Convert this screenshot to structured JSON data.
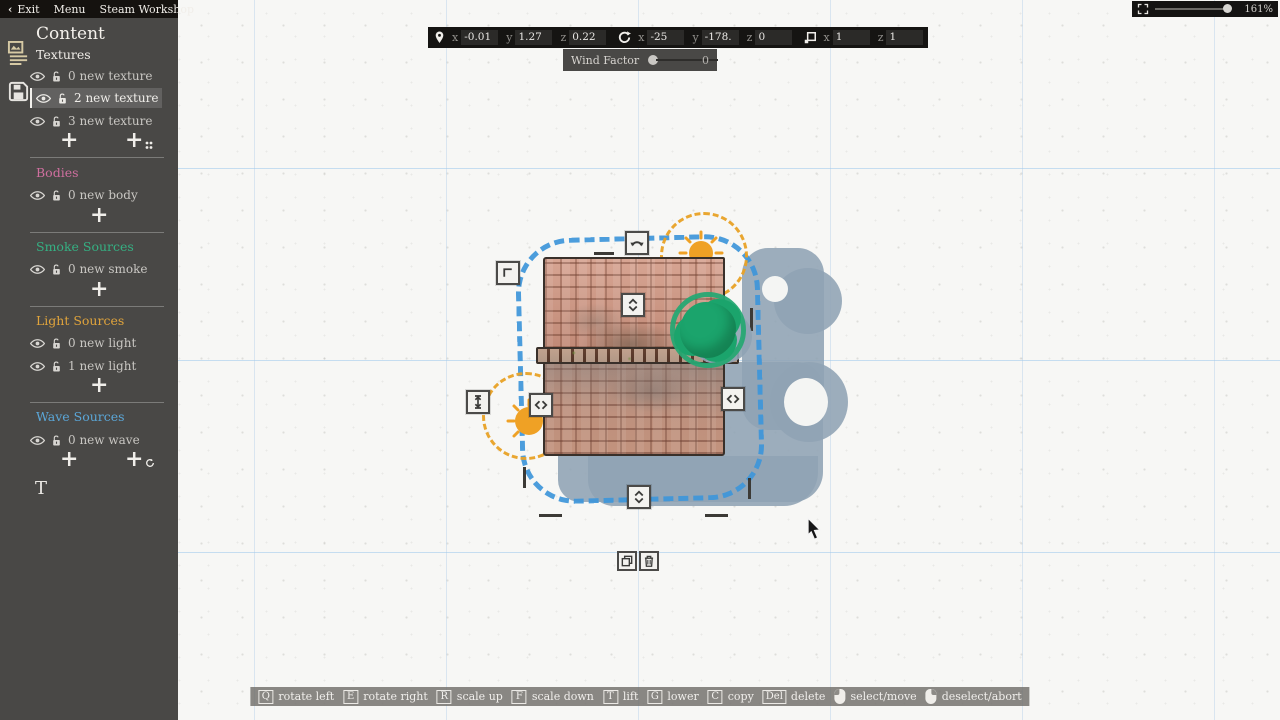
{
  "menu": {
    "back_arrow": "‹",
    "exit": "Exit",
    "menu": "Menu",
    "workshop": "Steam Workshop"
  },
  "sidebar": {
    "title": "Content",
    "textures": {
      "label": "Textures",
      "items": [
        "0 new texture",
        "2 new texture",
        "3 new texture"
      ],
      "selected_index": 1
    },
    "bodies": {
      "label": "Bodies",
      "items": [
        "0 new body"
      ]
    },
    "smoke": {
      "label": "Smoke Sources",
      "items": [
        "0 new smoke"
      ]
    },
    "light": {
      "label": "Light Sources",
      "items": [
        "0 new light",
        "1 new light"
      ]
    },
    "wave": {
      "label": "Wave Sources",
      "items": [
        "0 new wave"
      ]
    },
    "add_label": "+",
    "text_tool_label": "T"
  },
  "transform_bar": {
    "labels": {
      "x": "x",
      "y": "y",
      "z": "z"
    },
    "position": {
      "x": "-0.01",
      "y": "1.27",
      "z": "0.22"
    },
    "rotation": {
      "x": "-25",
      "y": "-178.",
      "z": "0"
    },
    "scale": {
      "x": "1",
      "z": "1"
    }
  },
  "wind": {
    "label": "Wind Factor",
    "value": "0"
  },
  "zoom_control": {
    "value": "161%"
  },
  "hotkeys": [
    {
      "key": "Q",
      "action": "rotate left"
    },
    {
      "key": "E",
      "action": "rotate right"
    },
    {
      "key": "R",
      "action": "scale up"
    },
    {
      "key": "F",
      "action": "scale down"
    },
    {
      "key": "T",
      "action": "lift"
    },
    {
      "key": "G",
      "action": "lower"
    },
    {
      "key": "C",
      "action": "copy"
    },
    {
      "key": "Del",
      "action": "delete"
    },
    {
      "mouse": "left",
      "action": "select/move"
    },
    {
      "mouse": "right",
      "action": "deselect/abort"
    }
  ],
  "colors": {
    "bodies_accent": "#cf6f9f",
    "smoke_accent": "#35b083",
    "light_accent": "#e0a43c",
    "wave_accent": "#5ba7d8",
    "selection_blue_outline": "#3e96da",
    "light_source_orange": "#e9a226",
    "tree_green": "#1ba46c",
    "shadow_blue_gray": "#8fa3b4",
    "sidebar_bg": "#494846",
    "bar_bg": "#151412"
  }
}
